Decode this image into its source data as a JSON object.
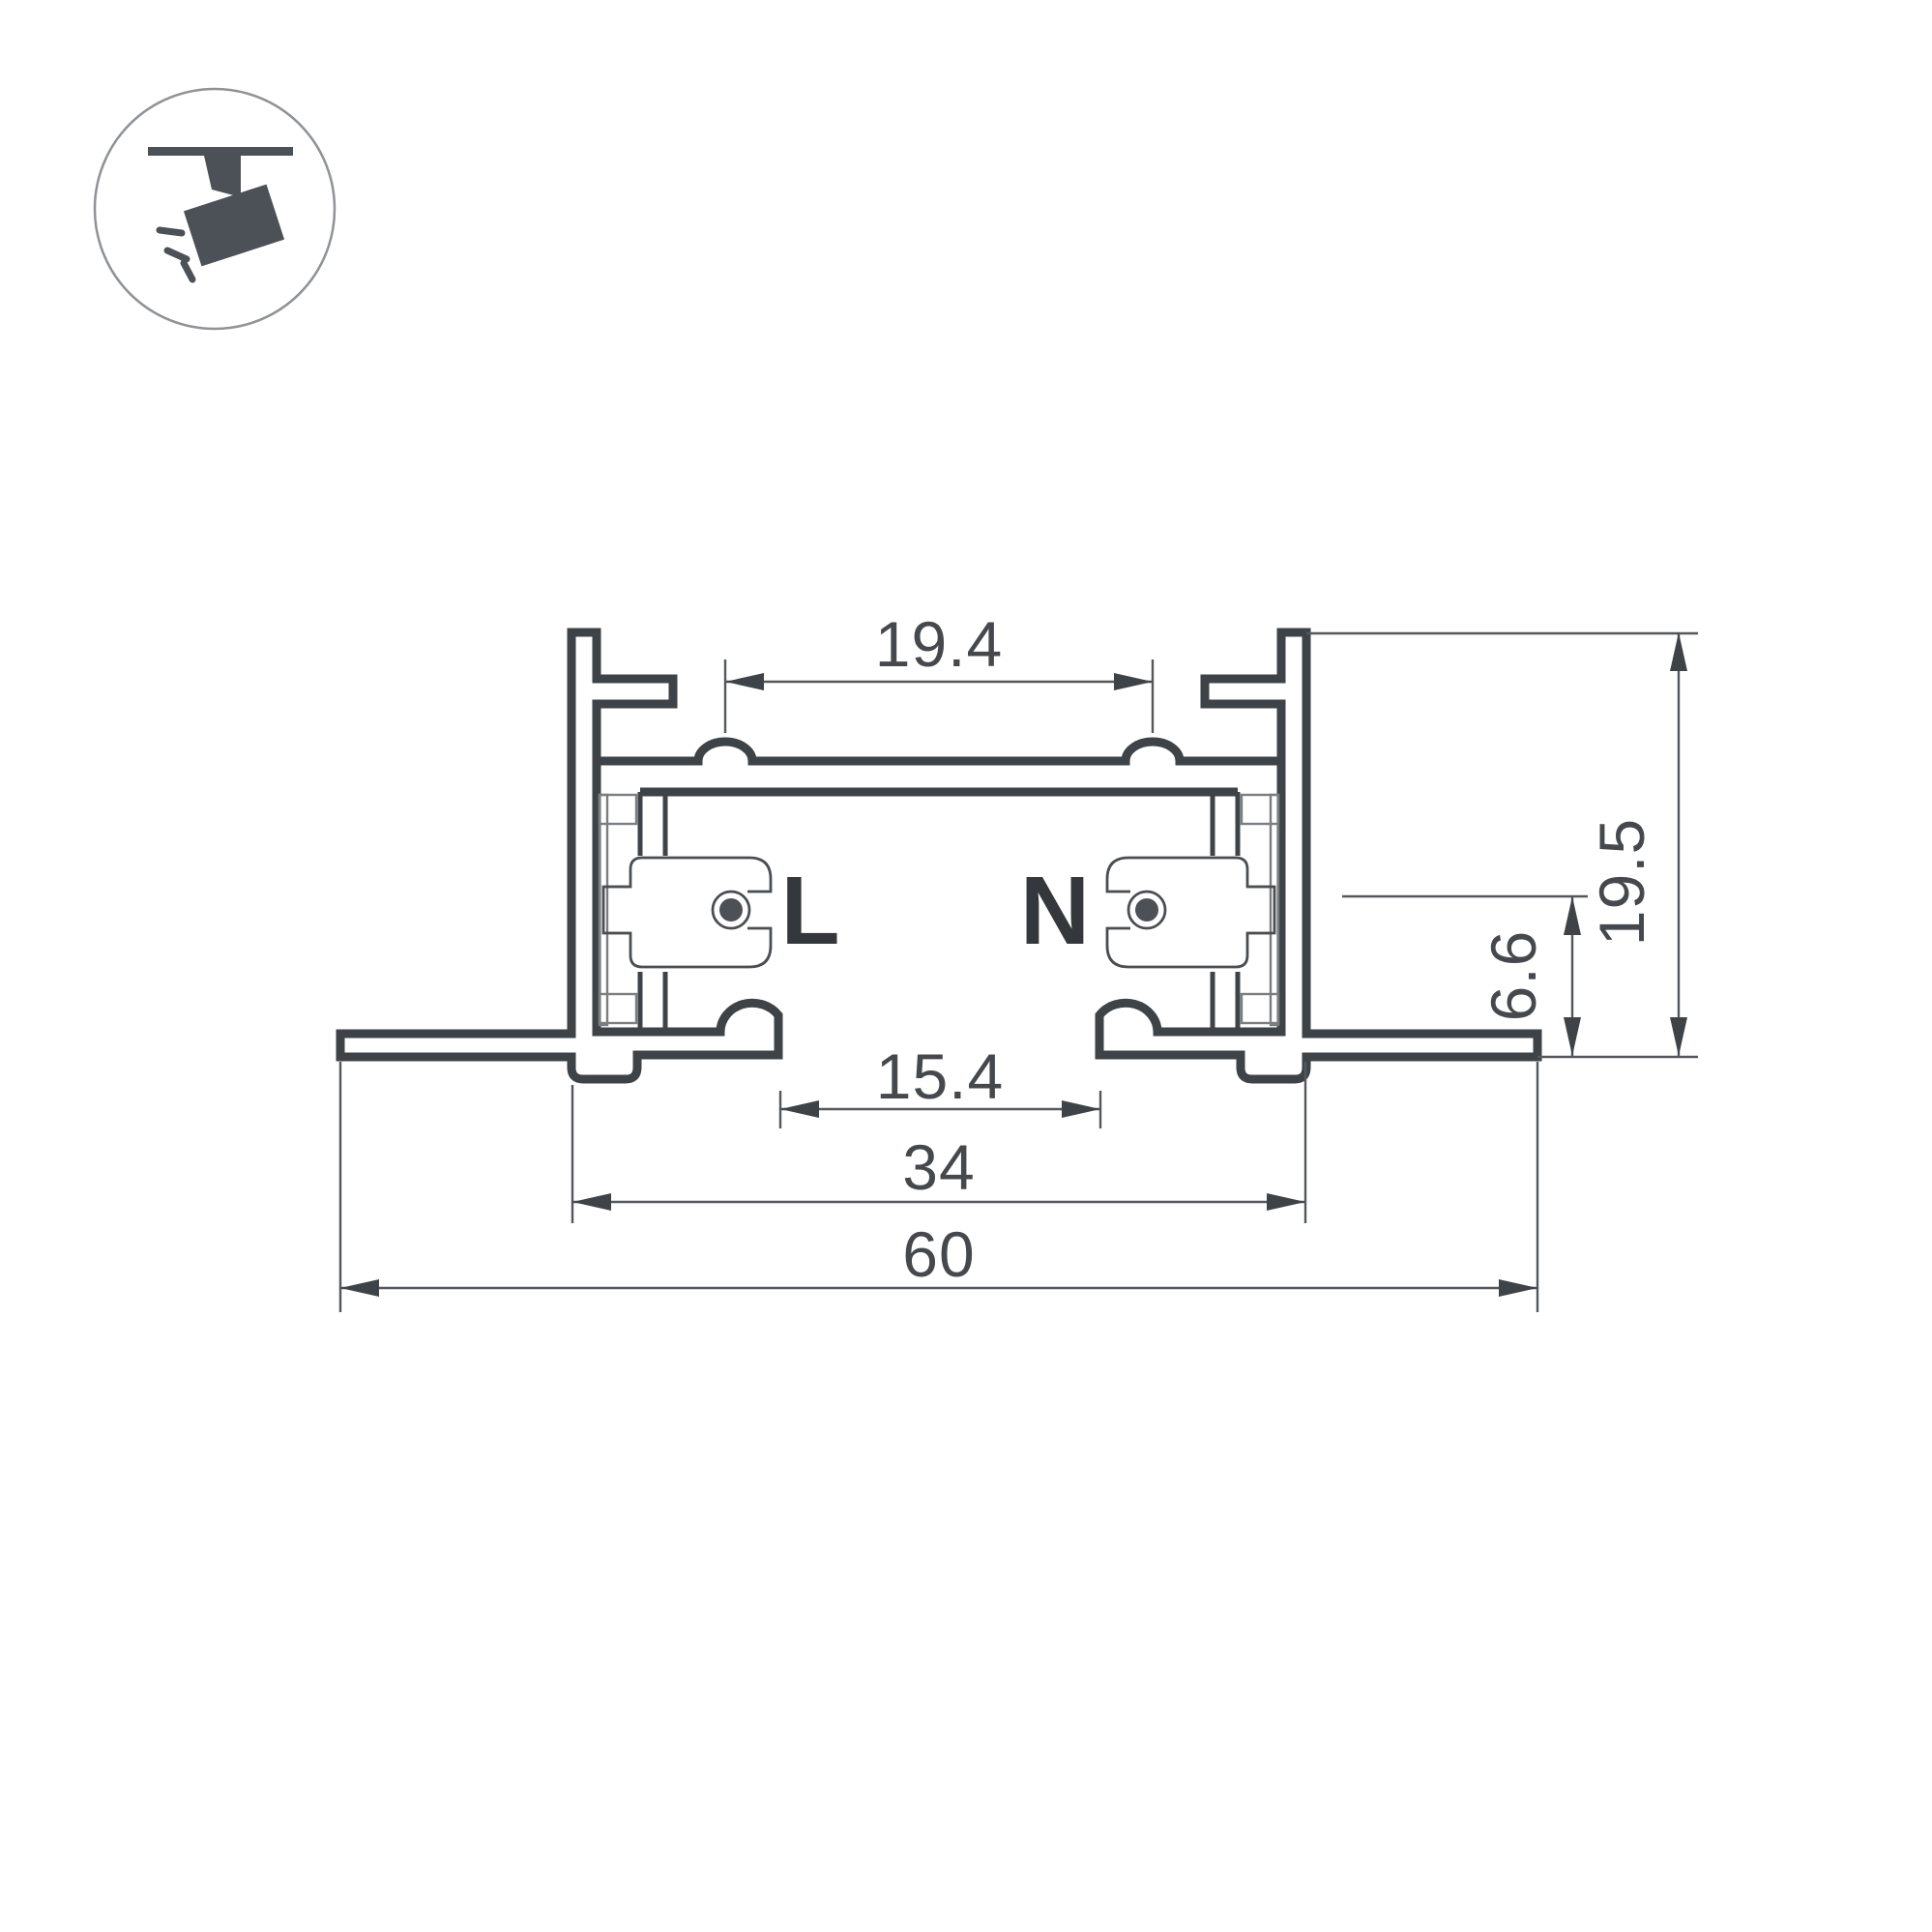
{
  "drawing": {
    "kind": "track-profile-cross-section",
    "background": "#ffffff"
  },
  "icon": {
    "name": "track-spotlight",
    "ring_color": "#8f9296",
    "fill_color": "#4c5157"
  },
  "conductors": {
    "live_label": "L",
    "neutral_label": "N",
    "dot_color": "#4c5157"
  },
  "dimensions": {
    "top_opening_width": {
      "value": "19.4"
    },
    "overall_height": {
      "value": "19.5"
    },
    "slot_height": {
      "value": "6.6"
    },
    "bottom_opening_width": {
      "value": "15.4"
    },
    "housing_width": {
      "value": "34"
    },
    "overall_width": {
      "value": "60"
    }
  },
  "colors": {
    "profile_line": "#3e4347",
    "thin_line": "#7a7e81",
    "dimension_line": "#54585c",
    "text": "#45494d"
  }
}
